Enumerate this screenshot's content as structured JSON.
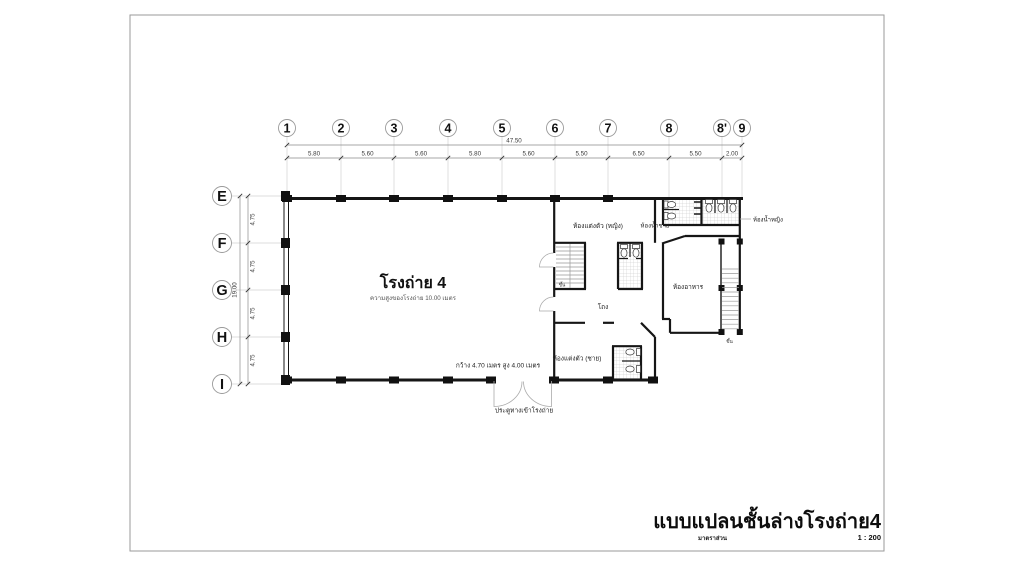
{
  "sheet": {
    "background": "#ffffff",
    "border_color": "#9a9a9a",
    "ink": "#161616",
    "light_line": "#cfcfcf"
  },
  "title_block": {
    "title": "แบบแปลนชั้นล่างโรงถ่าย4",
    "scale_label": "มาตราส่วน",
    "scale_value": "1 : 200"
  },
  "grid": {
    "columns": [
      "1",
      "2",
      "3",
      "4",
      "5",
      "6",
      "7",
      "8",
      "8'",
      "9"
    ],
    "column_spacings": [
      "5.80",
      "5.60",
      "5.60",
      "5.80",
      "5.60",
      "5.50",
      "6.50",
      "5.50",
      "2.00"
    ],
    "total_width": "47.50",
    "rows": [
      "E",
      "F",
      "G",
      "H",
      "I"
    ],
    "row_spacings": [
      "4.75",
      "4.75",
      "4.75",
      "4.75"
    ],
    "total_height": "19.00"
  },
  "rooms": {
    "studio": {
      "name": "โรงถ่าย 4",
      "height_note": "ความสูงของโรงถ่าย 10.00 เมตร"
    },
    "dressing_female": "ห้องแต่งตัว (หญิง)",
    "dressing_male": "ห้องแต่งตัว (ชาย)",
    "toilet_male": "ห้องน้ำชาย",
    "toilet_female": "ห้องน้ำหญิง",
    "dining": "ห้องอาหาร",
    "hall": "โถง"
  },
  "stairs": {
    "up_label": "ขึ้น"
  },
  "entrance": {
    "size_note": "กว้าง 4.70 เมตร สูง 4.00 เมตร",
    "label": "ประตูทางเข้าโรงถ่าย"
  }
}
